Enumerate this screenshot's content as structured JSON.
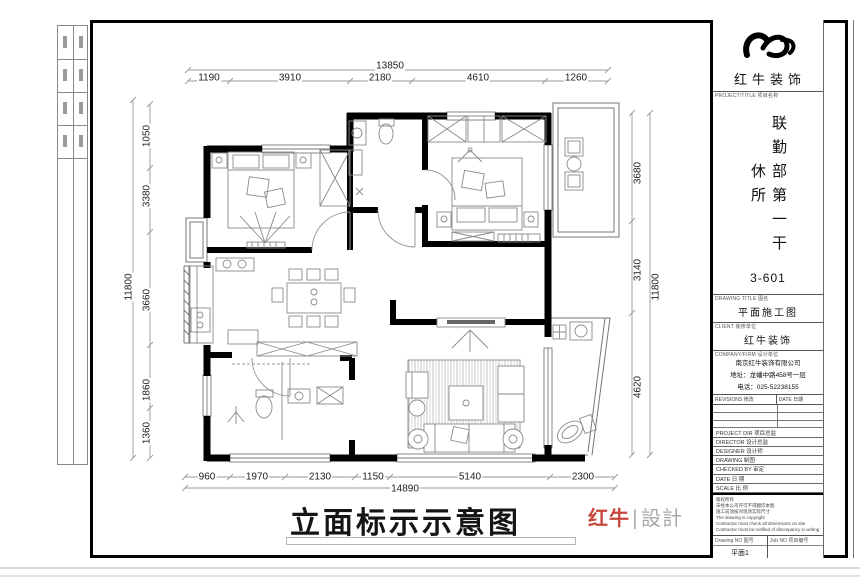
{
  "page": {
    "main_title": "立面标示示意图",
    "watermark_red": "红牛",
    "watermark_gray": "∣設計"
  },
  "dims": {
    "top": {
      "total": "13850",
      "segments": [
        "1190",
        "3910",
        "2180",
        "4610",
        "1260"
      ]
    },
    "bottom": {
      "total": "14890",
      "segments": [
        "960",
        "1970",
        "2130",
        "1150",
        "5140",
        "2300"
      ]
    },
    "left": {
      "total": "11800",
      "segments": [
        "1050",
        "3380",
        "3660",
        "1860",
        "1360"
      ]
    },
    "right": {
      "total": "11800",
      "segments": [
        "3680",
        "3140",
        "4620"
      ]
    }
  },
  "title_block": {
    "brand": "红牛装饰",
    "project_label": "PROJECT/TITLE 项目名称",
    "project_name": "联勤部第一干休所",
    "project_no": "3-601",
    "drawing_title_label": "DRAWING TITLE 图名",
    "drawing_title": "平面施工图",
    "client_label": "CLIENT 装修单位",
    "client": "红牛装饰",
    "company_label": "COMPANY/FIRM 设计单位",
    "company_name": "南京红牛装饰有限公司",
    "company_address": "地址：龙蟠中路458号一层",
    "company_phone": "电话：025-52238155",
    "revisions_label": "REVISIONS 修改",
    "date_col_label": "DATE 日期",
    "rows": [
      {
        "label": "PROJECT DIR 项目总监",
        "value": ""
      },
      {
        "label": "DIRECTOR 设计总监",
        "value": ""
      },
      {
        "label": "DESIGNER 设计师",
        "value": ""
      },
      {
        "label": "DRAWING 制图",
        "value": ""
      },
      {
        "label": "CHECKED BY 审定",
        "value": ""
      },
      {
        "label": "DATE 日 期",
        "value": ""
      },
      {
        "label": "SCALE 比 例",
        "value": ""
      }
    ],
    "notes": [
      "版权所有",
      "未经本公司许可不得翻印本图",
      "施工前须核对现场实际尺寸",
      "The drawing is copyright",
      "Contractor must check all dimensions on site",
      "Contractor must be notified of discrepancy in writing"
    ],
    "drawing_no_label": "Drawing NO 图号",
    "drawing_no": "平面1",
    "job_no_label": "Job NO 项目编号",
    "job_no": ""
  }
}
